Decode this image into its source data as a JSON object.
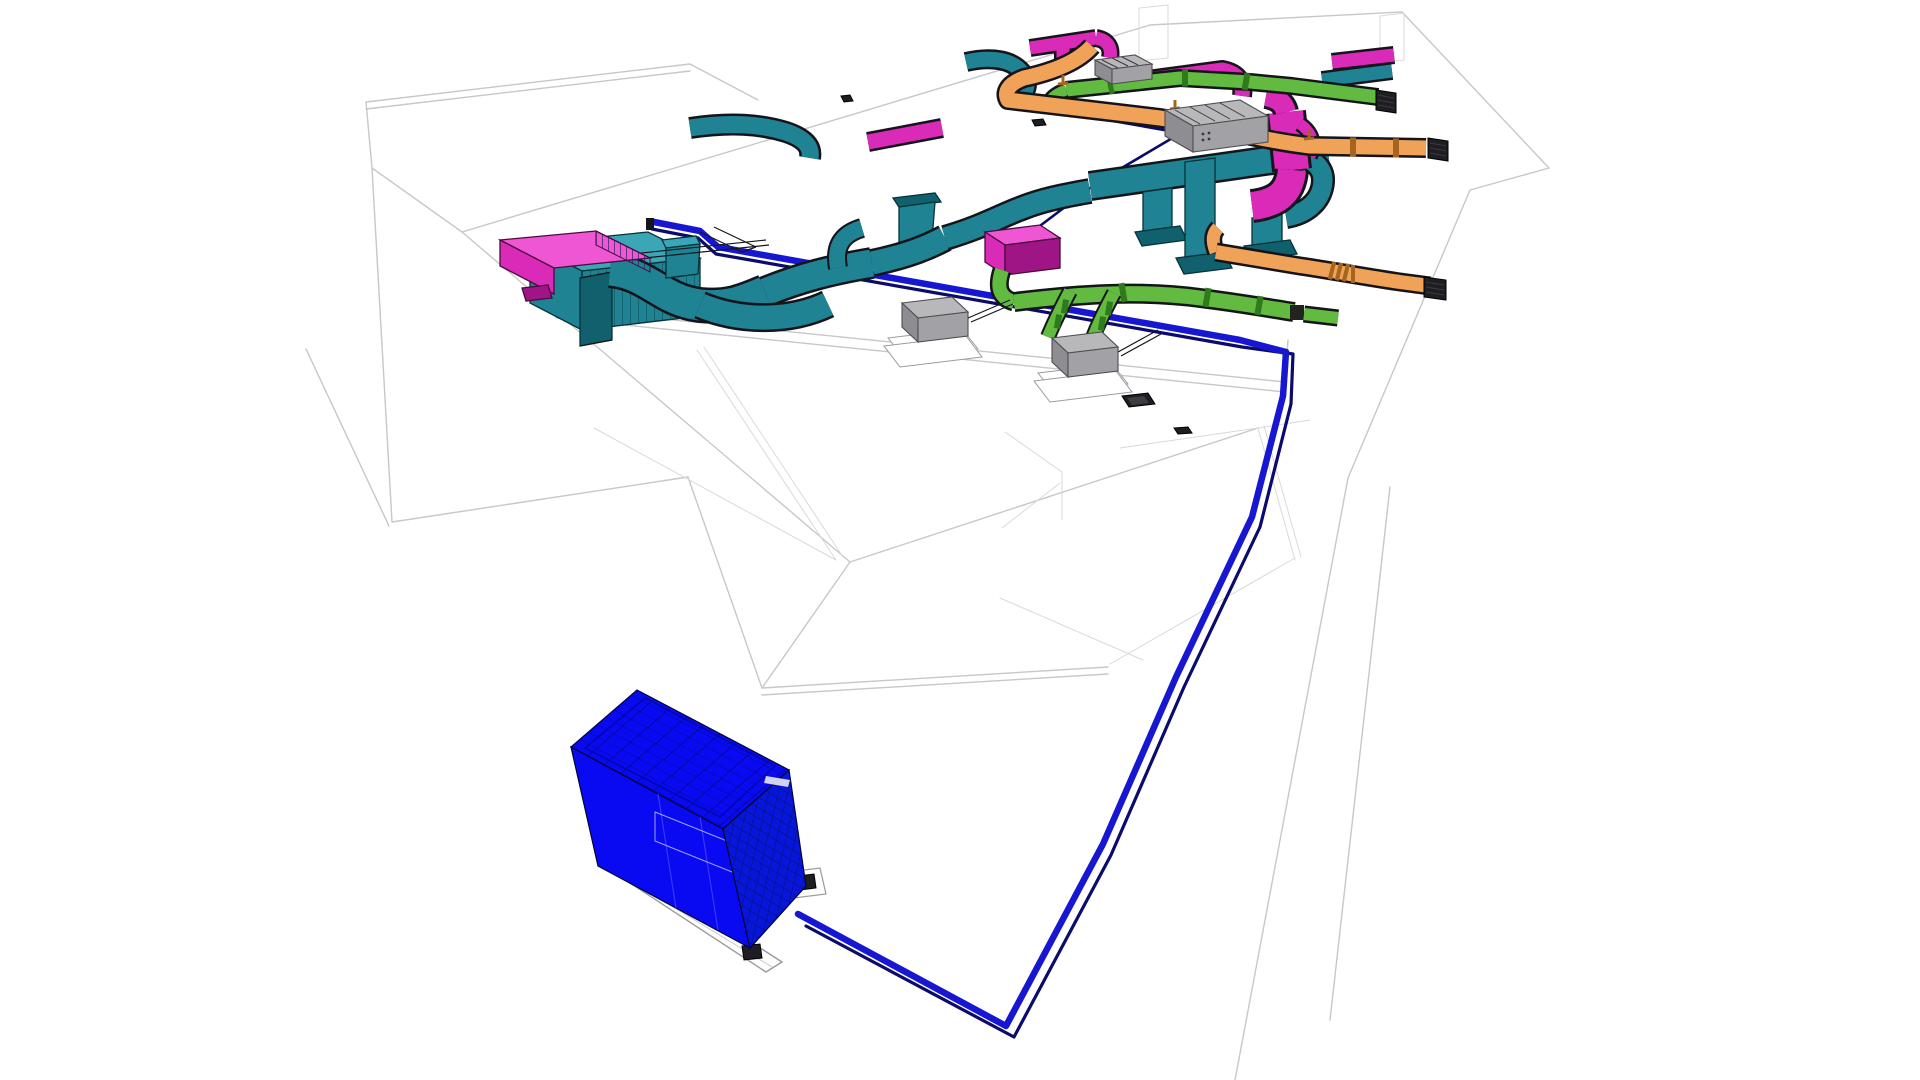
{
  "app": {
    "label": "3D HVAC and piping coordination model view",
    "background": "#ffffff"
  },
  "canvas": {
    "width": 1920,
    "height": 1080
  },
  "systems": [
    {
      "id": "supply-air-duct",
      "label": "supply air ductwork (teal)",
      "color": "#1f8394"
    },
    {
      "id": "exhaust-air-duct",
      "label": "exhaust air ductwork (magenta)",
      "color": "#d92ab8"
    },
    {
      "id": "outside-air-duct",
      "label": "outside air round duct (green)",
      "color": "#63ba41"
    },
    {
      "id": "return-air-duct",
      "label": "return air duct (orange)",
      "color": "#f0a259"
    },
    {
      "id": "chilled-water-supply",
      "label": "chilled water supply pipe (blue)",
      "color": "#1717d2"
    },
    {
      "id": "chilled-water-return",
      "label": "chilled water return pipe (navy)",
      "color": "#0b0b6e"
    },
    {
      "id": "air-cooled-chiller",
      "label": "air-cooled chiller unit",
      "color": "#0a0af2"
    },
    {
      "id": "rooftop-unit",
      "label": "rooftop condensing units",
      "color": "#a2a2a6"
    },
    {
      "id": "building-wireframe",
      "label": "building shell wireframe",
      "color": "#c7c7cc"
    }
  ]
}
